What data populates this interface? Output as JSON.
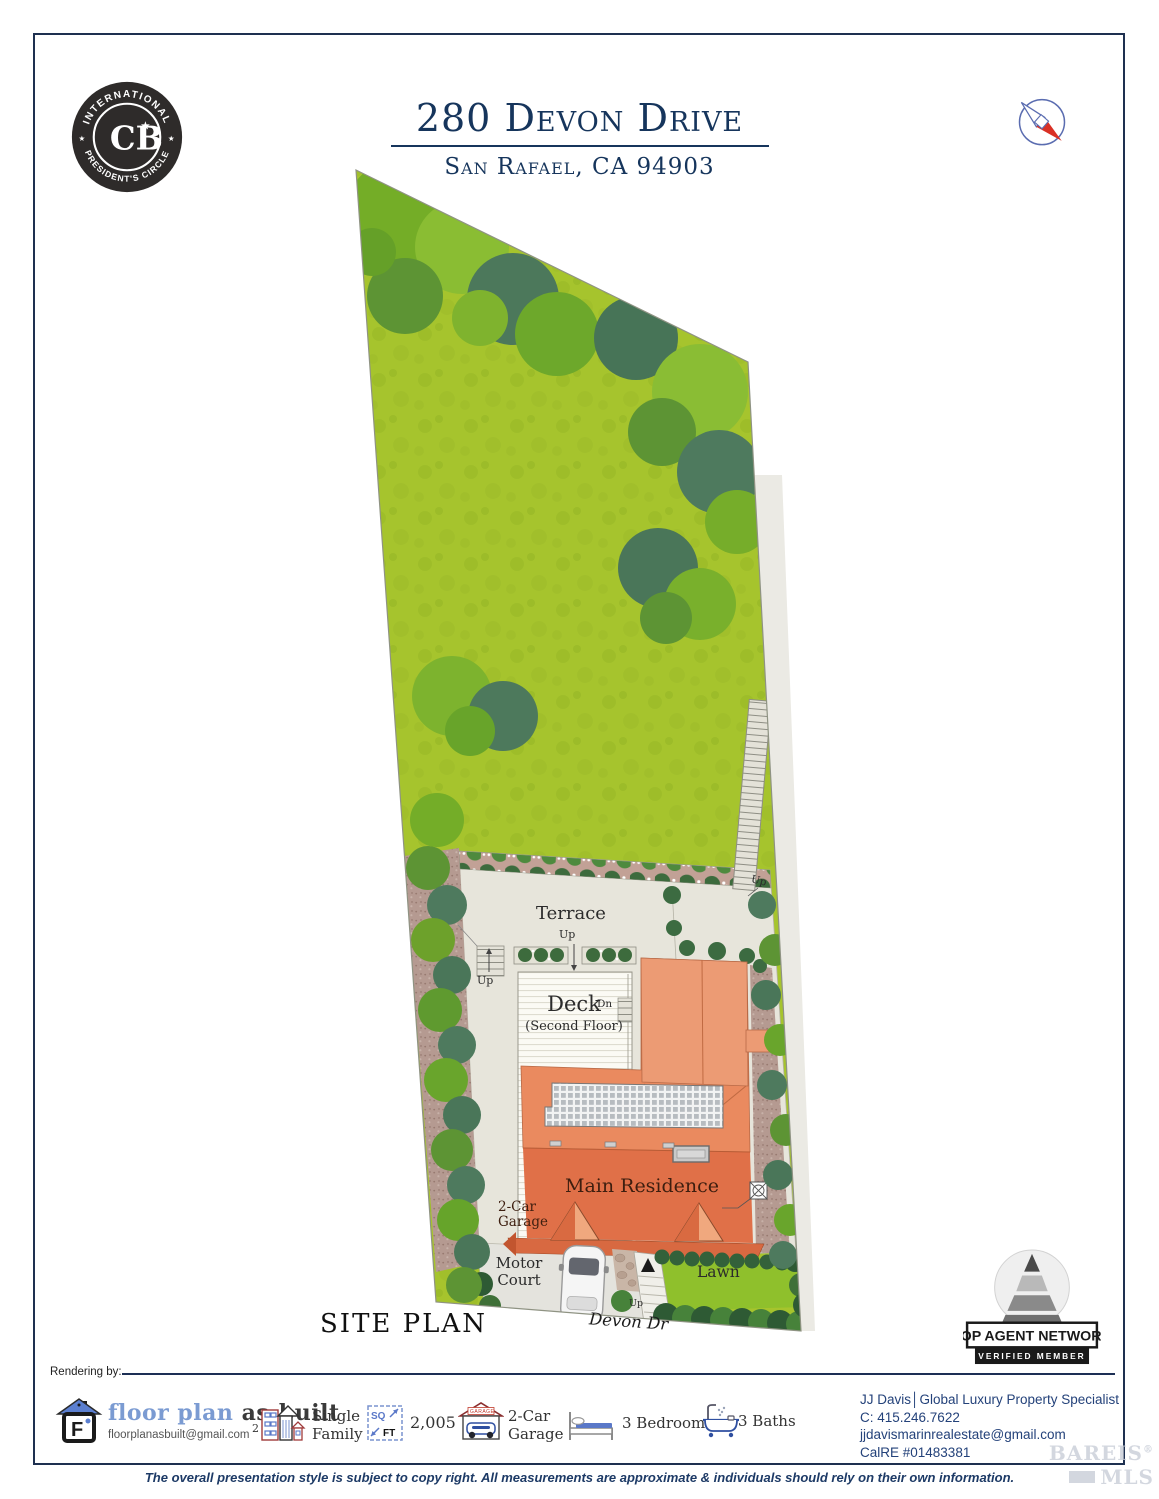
{
  "colors": {
    "navy": "#16355c",
    "roof_orange": "#e8855c",
    "lawn_green": "#a6c42d"
  },
  "header": {
    "badge": {
      "arc_top": "INTERNATIONAL",
      "arc_bottom": "PRESIDENT'S CIRCLE",
      "monogram": "CB",
      "star": "★"
    },
    "title": "280 Devon Drive",
    "subtitle": "San Rafael, CA 94903"
  },
  "plan": {
    "caption": "SITE PLAN",
    "labels": {
      "terrace": "Terrace",
      "deck": "Deck",
      "deck_sub": "(Second Floor)",
      "up": "Up",
      "dn": "Dn",
      "main_residence": "Main Residence",
      "garage_l1": "2-Car",
      "garage_l2": "Garage",
      "motor_l1": "Motor",
      "motor_l2": "Court",
      "lawn": "Lawn",
      "street": "Devon Dr"
    }
  },
  "top_agent": {
    "title": "TOP AGENT NETWORK",
    "subtitle": "VERIFIED MEMBER"
  },
  "footer": {
    "rendering_by": "Rendering by:",
    "vendor": {
      "brand_blue": "floor plan",
      "brand_dark": " as-built",
      "email": "floorplanasbuilt@gmail.com"
    },
    "stats": {
      "type_prefix": "2",
      "type_l1": "Single",
      "type_l2": "Family",
      "sqft_top": "SQ",
      "sqft_bottom": "FT",
      "sqft_value": "2,005",
      "garage_icon_text": "GARAGE",
      "garage_l1": "2-Car",
      "garage_l2": "Garage",
      "beds": "3 Bedrooms",
      "baths": "3 Baths"
    },
    "agent": {
      "line1": "JJ Davis│Global Luxury Property Specialist",
      "line2": "C: 415.246.7622",
      "line3": "jjdavismarinrealestate@gmail.com",
      "line4": "CalRE #01483381"
    },
    "disclaimer": "The overall presentation style is subject to copy right. All measurements are approximate & individuals should rely on their own information.",
    "watermark": {
      "l1": "BAREIS",
      "reg": "®",
      "l2": "MLS"
    }
  }
}
